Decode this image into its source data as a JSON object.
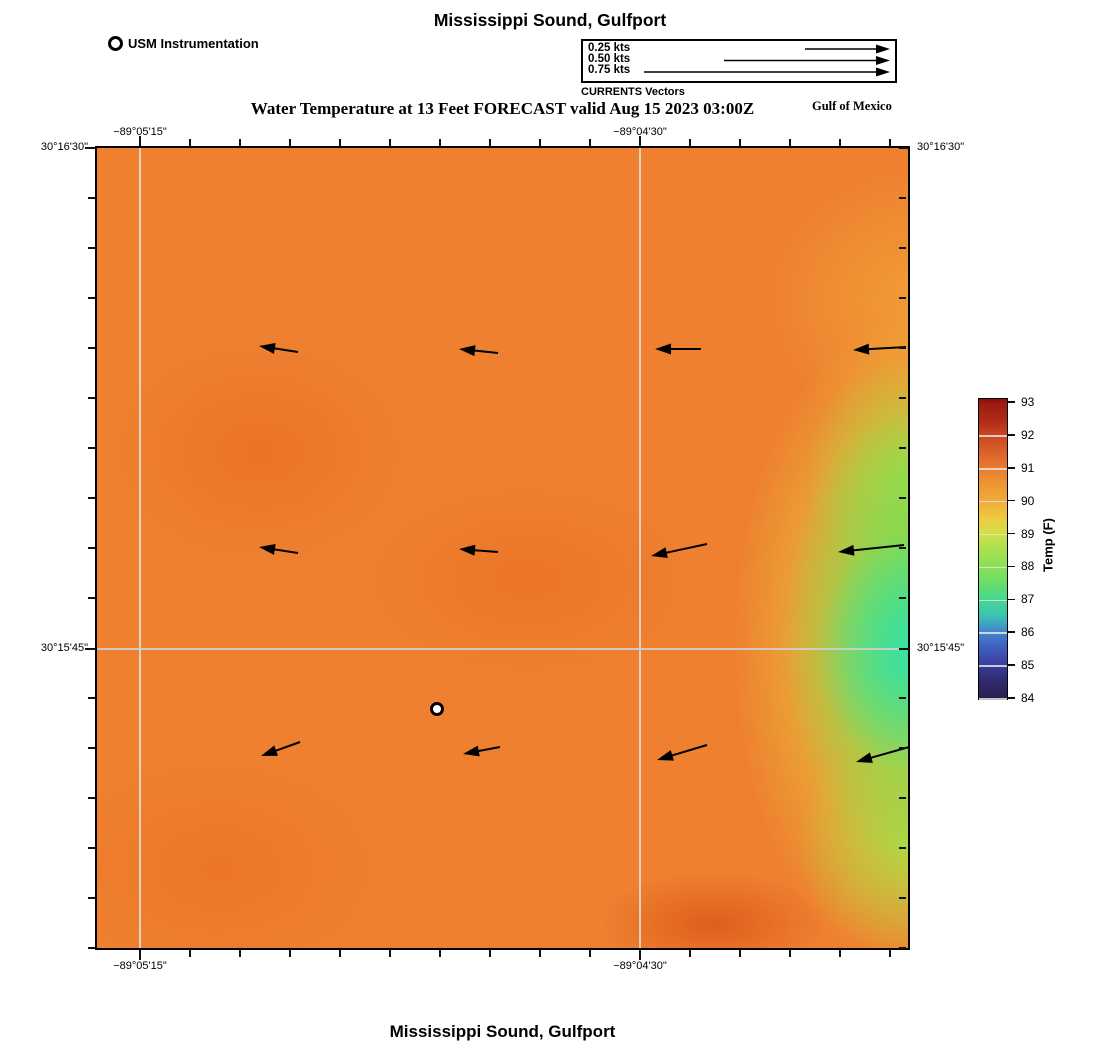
{
  "header": {
    "title": "Mississippi Sound, Gulfport",
    "forecast_title": "Water Temperature at 13 Feet FORECAST valid Aug 15 2023 03:00Z",
    "region_label": "Gulf of Mexico"
  },
  "footer": {
    "title": "Mississippi Sound, Gulfport"
  },
  "legend": {
    "station_label": "USM Instrumentation",
    "vectors_caption": "CURRENTS Vectors",
    "vector_entries": [
      {
        "label": "0.25 kts",
        "x_start": 222,
        "y": 8
      },
      {
        "label": "0.50 kts",
        "x_start": 141,
        "y": 19.5
      },
      {
        "label": "0.75 kts",
        "x_start": 61,
        "y": 31
      }
    ],
    "vector_tip_x": 307
  },
  "colors": {
    "map_base": "#ee8030",
    "grid_line": "#d8d8d8",
    "arrow": "#000000",
    "station_fill": "#ffffff",
    "text": "#000000"
  },
  "map": {
    "x_axis_labels": [
      {
        "text": "−89°05'15\"",
        "rel_x": 43
      },
      {
        "text": "−89°04'30\"",
        "rel_x": 543
      }
    ],
    "y_axis_labels": [
      {
        "text": "30°16'30\"",
        "rel_y": 0
      },
      {
        "text": "30°15'45\"",
        "rel_y": 501
      }
    ],
    "grid": {
      "vx": [
        43,
        543
      ],
      "hy": [
        501
      ]
    },
    "xticks": [
      43,
      93,
      143,
      193,
      243,
      293,
      343,
      393,
      443,
      493,
      543,
      593,
      643,
      693,
      743,
      793
    ],
    "yticks": [
      0,
      50,
      100,
      150,
      200,
      250,
      300,
      350,
      400,
      450,
      501,
      550,
      600,
      650,
      700,
      750,
      800
    ],
    "major_xticks": [
      43,
      543
    ],
    "major_yticks": [
      0,
      501
    ],
    "station_marker": {
      "rel_x": 340,
      "rel_y": 561
    },
    "arrows": [
      {
        "tail": [
          201,
          204
        ],
        "tip": [
          162,
          198
        ]
      },
      {
        "tail": [
          401,
          205
        ],
        "tip": [
          362,
          201
        ]
      },
      {
        "tail": [
          604,
          201
        ],
        "tip": [
          558,
          201
        ]
      },
      {
        "tail": [
          809,
          199
        ],
        "tip": [
          756,
          202
        ]
      },
      {
        "tail": [
          201,
          405
        ],
        "tip": [
          162,
          399
        ]
      },
      {
        "tail": [
          401,
          404
        ],
        "tip": [
          362,
          401
        ]
      },
      {
        "tail": [
          610,
          396
        ],
        "tip": [
          554,
          408
        ]
      },
      {
        "tail": [
          807,
          397
        ],
        "tip": [
          741,
          404
        ]
      },
      {
        "tail": [
          203,
          594
        ],
        "tip": [
          164,
          608
        ]
      },
      {
        "tail": [
          403,
          599
        ],
        "tip": [
          366,
          606
        ]
      },
      {
        "tail": [
          610,
          597
        ],
        "tip": [
          560,
          612
        ]
      },
      {
        "tail": [
          812,
          599
        ],
        "tip": [
          759,
          614
        ]
      }
    ]
  },
  "colorbar": {
    "title": "Temp (F)",
    "ticks": [
      93,
      92,
      91,
      90,
      89,
      88,
      87,
      86,
      85,
      84
    ],
    "range": [
      84,
      93
    ],
    "gradient_stops": [
      [
        0,
        "#8a0f0f"
      ],
      [
        1.5,
        "#9c1a11"
      ],
      [
        7,
        "#b02a16"
      ],
      [
        12.2,
        "#cb4522"
      ],
      [
        17,
        "#d85e28"
      ],
      [
        23.1,
        "#e97b2e"
      ],
      [
        28,
        "#ee9434"
      ],
      [
        34,
        "#f0ab39"
      ],
      [
        40,
        "#edcc41"
      ],
      [
        44.9,
        "#cfdf48"
      ],
      [
        50,
        "#abe050"
      ],
      [
        55.8,
        "#8cdf56"
      ],
      [
        61,
        "#6cdd68"
      ],
      [
        66.7,
        "#46d88f"
      ],
      [
        72,
        "#3cc4b2"
      ],
      [
        77.6,
        "#4286cd"
      ],
      [
        83,
        "#3f5cc0"
      ],
      [
        88.5,
        "#3a3f9e"
      ],
      [
        94,
        "#2f2a6b"
      ],
      [
        99.4,
        "#2a2152"
      ],
      [
        100,
        "#282050"
      ]
    ]
  },
  "chart_data": {
    "type": "heatmap",
    "title": "Mississippi Sound, Gulfport",
    "subtitle": "Water Temperature at 13 Feet FORECAST valid Aug 15 2023 03:00Z",
    "x_axis": {
      "label": "Longitude",
      "tick_labels": [
        "−89°05'15\"",
        "−89°04'30\""
      ]
    },
    "y_axis": {
      "label": "Latitude",
      "tick_labels": [
        "30°16'30\"",
        "30°15'45\""
      ]
    },
    "colorbar": {
      "label": "Temp (F)",
      "range": [
        84,
        93
      ],
      "ticks": [
        93,
        92,
        91,
        90,
        89,
        88,
        87,
        86,
        85,
        84
      ]
    },
    "field_summary": "Water temperature mostly 90-91 F (orange) across the sound; cools to 87-88 F (green/teal band) along the eastern edge near 30°15'45\"; warmer ~91 F deep-orange patch near the south-central bottom edge",
    "vectors": {
      "legend_speeds_kts": [
        0.25,
        0.5,
        0.75
      ],
      "direction": "westward (arrows point left, slight southwest tilt in bottom row)",
      "layout": "3 rows x 4 columns across the map"
    },
    "station": {
      "name": "USM Instrumentation",
      "symbol": "white circle with black ring",
      "map_position": "south-central"
    },
    "annotations": [
      "CURRENTS Vectors",
      "Gulf of Mexico"
    ],
    "grid": "lat/lon graticule lines at −89°05'15\", −89°04'30\" and 30°15'45\""
  }
}
